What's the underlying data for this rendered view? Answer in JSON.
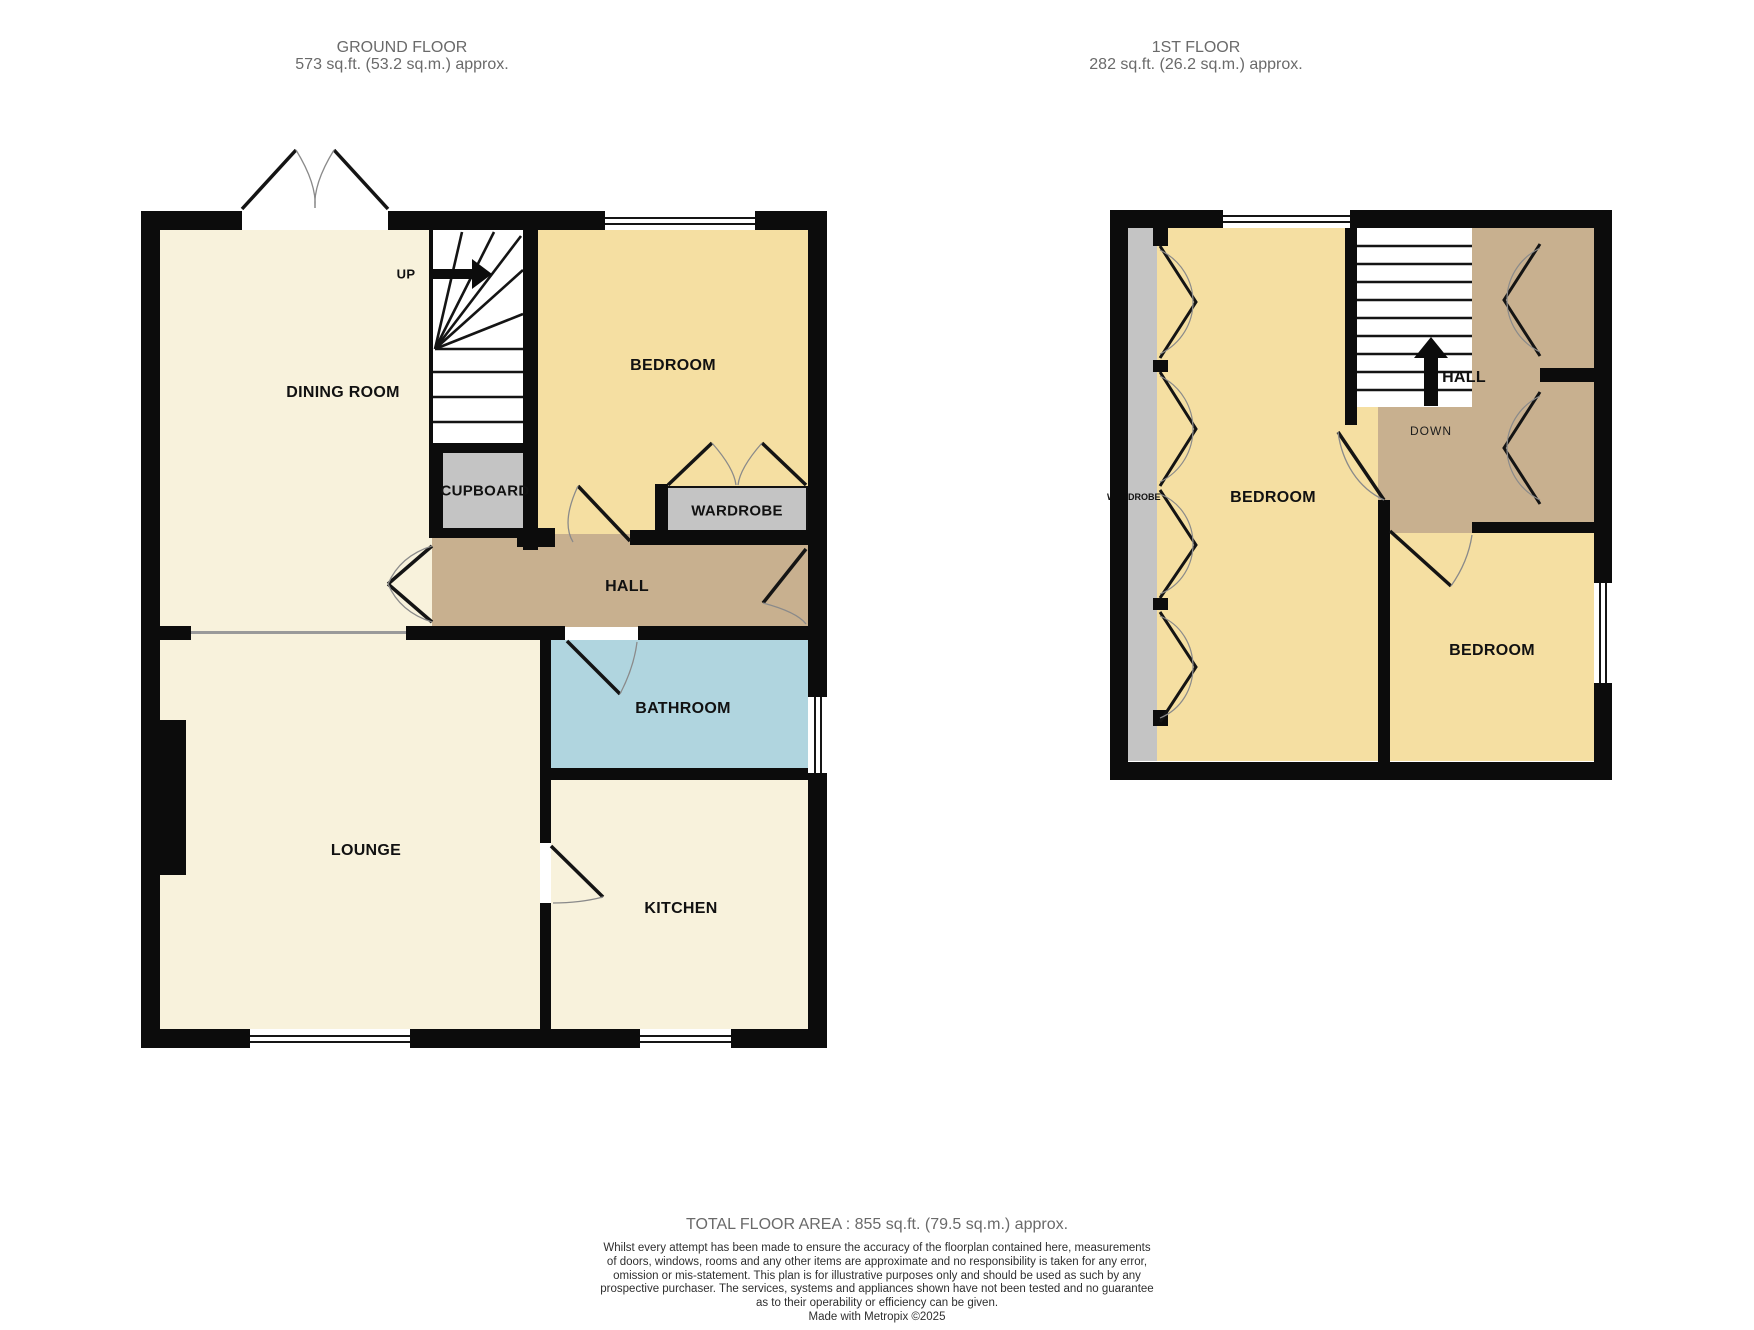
{
  "ground_floor": {
    "title": "GROUND FLOOR",
    "subtitle": "573 sq.ft. (53.2 sq.m.) approx.",
    "rooms": {
      "dining_room": "DINING ROOM",
      "bedroom": "BEDROOM",
      "cupboard": "CUPBOARD",
      "wardrobe": "WARDROBE",
      "hall": "HALL",
      "bathroom": "BATHROOM",
      "lounge": "LOUNGE",
      "kitchen": "KITCHEN",
      "stairs_direction": "UP"
    }
  },
  "first_floor": {
    "title": "1ST FLOOR",
    "subtitle": "282 sq.ft. (26.2 sq.m.) approx.",
    "rooms": {
      "bedroom_left": "BEDROOM",
      "bedroom_right": "BEDROOM",
      "hall": "HALL",
      "wardrobe": "WARDROBE",
      "stairs_direction": "DOWN"
    }
  },
  "footer": {
    "total": "TOTAL FLOOR AREA : 855 sq.ft. (79.5 sq.m.) approx.",
    "disclaimer_lines": [
      "Whilst every attempt has been made to ensure the accuracy of the floorplan contained here, measurements",
      "of doors, windows, rooms and any other items are approximate and no responsibility is taken for any error,",
      "omission or mis-statement. This plan is for illustrative purposes only and should be used as such by any",
      "prospective purchaser. The services, systems and appliances shown have not been tested and no guarantee",
      "as to their operability or efficiency can be given."
    ],
    "credit": "Made with Metropix ©2025"
  },
  "colors": {
    "room_cream": "#F8F2DC",
    "room_yellow": "#F5DFA2",
    "room_tan": "#C8B08F",
    "room_blue": "#B0D5DF",
    "room_gray": "#C4C4C4",
    "wall": "#0C0C0C"
  }
}
